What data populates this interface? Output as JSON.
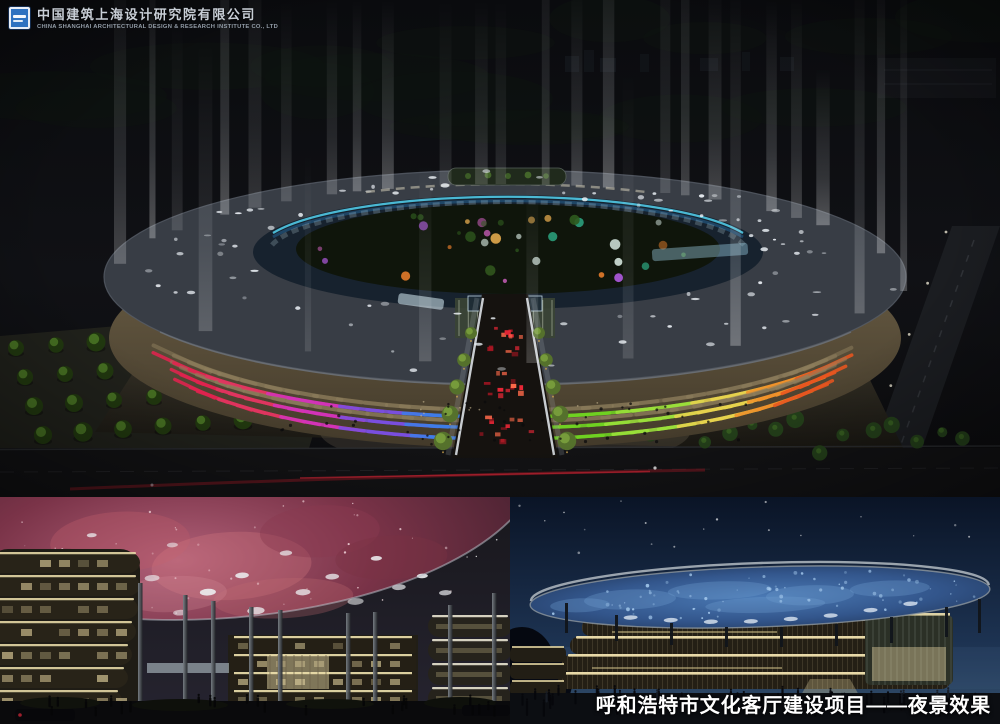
{
  "logo": {
    "icon": "company-seal-icon",
    "company_name_zh": "中国建筑上海设计研究院有限公司",
    "company_name_en": "CHINA SHANGHAI ARCHITECTURAL DESIGN & RESEARCH INSTITUTE CO., LTD"
  },
  "caption": {
    "text": "呼和浩特市文化客厅建设项目——夜景效果"
  },
  "colors": {
    "page_background": "#000000",
    "logo_seal_blue": "#2e72c0",
    "logo_text": "#c8ced6",
    "logo_subtext": "#939da8",
    "caption_text": "#ffffff",
    "facade_accents": [
      "#e0234f",
      "#e03560",
      "#d433b8",
      "#7a4fe0",
      "#3f7de8",
      "#6fd321",
      "#9be03a",
      "#e8d44d",
      "#f0922a",
      "#e8551f"
    ],
    "inner_ring_glow": "#54d2f0",
    "beam_light": "#ffffff",
    "nebula_canopy": "#a4485e",
    "starry_disc": "#3a6298",
    "warm_band": "#f0e2ae",
    "stone_band": "#8f7f5e"
  }
}
